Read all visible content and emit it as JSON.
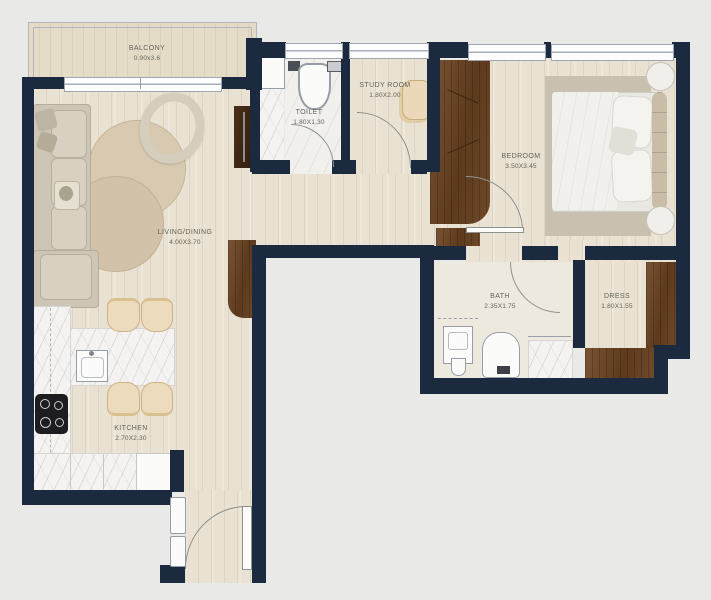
{
  "plan": {
    "rooms": [
      {
        "name": "BALCONY",
        "dims": "0.90x3.6"
      },
      {
        "name": "LIVING/DINING",
        "dims": "4.00X3.70"
      },
      {
        "name": "KITCHEN",
        "dims": "2.70X2.30"
      },
      {
        "name": "TOILET",
        "dims": "1.80X1.30"
      },
      {
        "name": "STUDY ROOM",
        "dims": "1.80X2.00"
      },
      {
        "name": "BEDROOM",
        "dims": "3.50X3.45"
      },
      {
        "name": "BATH",
        "dims": "2.35X1.75"
      },
      {
        "name": "DRESS",
        "dims": "1.80X1.55"
      }
    ],
    "colors": {
      "wall": "#1c2a40",
      "background": "#e9e9e7",
      "wood_floor": "#e9e1d1",
      "cabinet_wood": "#6b4727",
      "furniture_beige": "#ecdbbc"
    }
  }
}
